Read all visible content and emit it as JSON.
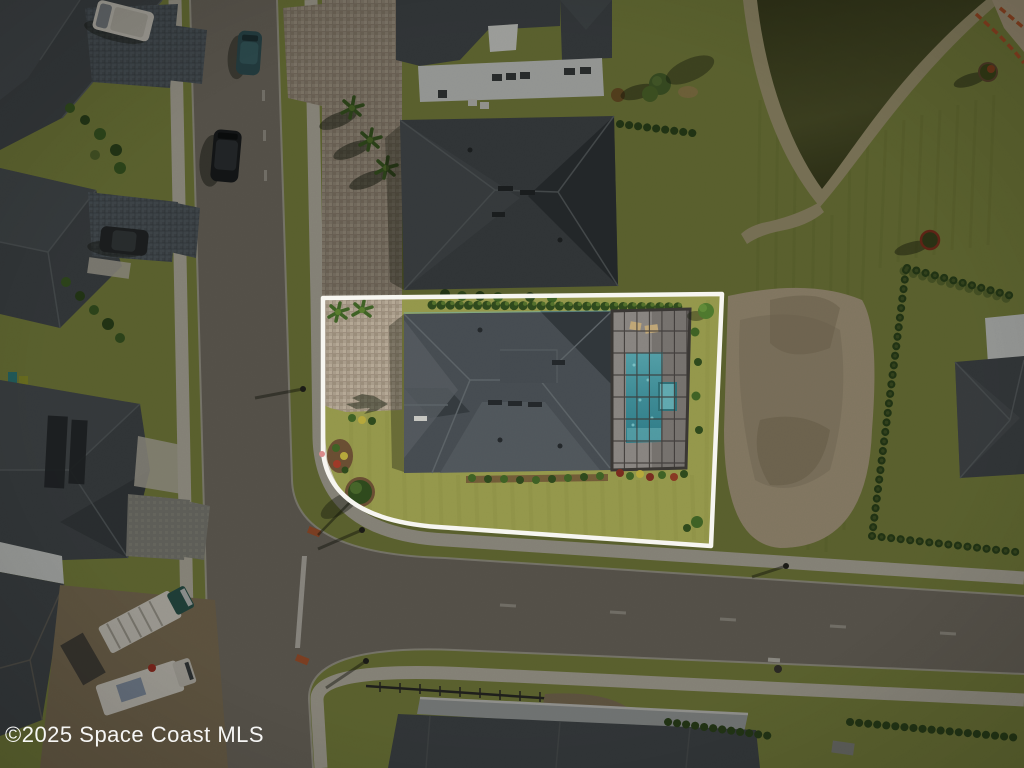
{
  "image": {
    "type": "aerial-property-photo",
    "description": "Overhead drone photo of a corner residential lot outlined in white, containing a single-family home with screened pool enclosure; surrounding streets, neighboring homes, bare dirt lot and retention pond are dimmed",
    "watermark": "©2025 Space Coast MLS"
  },
  "scene": {
    "highlighted_lot": "corner lot with house, paver driveway, screened pool",
    "pool": "rectangular teal pool with spa inside bronze screen enclosure",
    "roads": "T-intersection: vertical street on left, cross street along bottom",
    "pond": "dark retention pond, top right",
    "vehicles": "white van, teal sedan, black SUV, two white box trucks"
  },
  "colors": {
    "grass_base": "#879144",
    "grass_lot": "#96994c",
    "road_asphalt": "#7e786d",
    "road_curb": "#b9b5a8",
    "sidewalk": "#c9c4b5",
    "roof_shingle": "#474d52",
    "roof_light": "#565d62",
    "roof_dark": "#2f3539",
    "wall_white": "#dfe2e0",
    "pond_water": "#565b2d",
    "pond_dark": "#3f431f",
    "sand_bank": "#b3a87f",
    "dirt_bright": "#c4b393",
    "dirt_soil": "#8a7a5e",
    "pool_water": "#3e8c96",
    "pool_step": "#62abb1",
    "enclosure_deck": "#8a8682",
    "enclosure_frame": "#3a3734",
    "shrub_green": "#3f6325",
    "shrub_dark": "#2f4a1d",
    "mulch_brown": "#6b4f33",
    "vehicle_white": "#e8e4da",
    "vehicle_teal": "#31555c",
    "vehicle_black": "#1a1d1f",
    "safety_orange": "#c05a2c",
    "overlay_shade": "rgba(8,10,6,0.35)",
    "outline_white": "#f7f6f1",
    "watermark_white": "rgba(255,255,255,0.95)"
  }
}
